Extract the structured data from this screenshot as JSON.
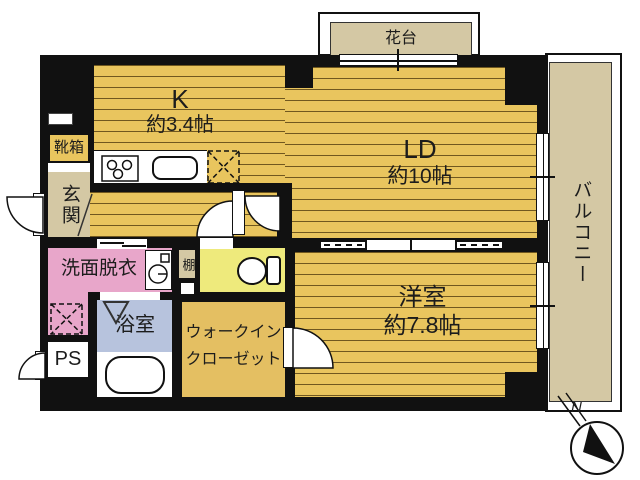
{
  "plan_title": "apartment floor plan",
  "colors": {
    "floor_wood": "#e9c55e",
    "tan": "#d4c8a4",
    "wall": "#111111",
    "washroom_pink": "#e8a6ca",
    "bath_blue": "#b7c3dd",
    "toilet_yellow": "#eeea7c",
    "closet_tan": "#e4bf62"
  },
  "rooms": {
    "kitchen": {
      "label": "K",
      "size": "約3.4帖"
    },
    "living_dining": {
      "label": "LD",
      "size": "約10帖"
    },
    "western_room": {
      "label": "洋室",
      "size": "約7.8帖"
    },
    "entrance": {
      "label": "玄関"
    },
    "shoe_box": {
      "label": "靴箱"
    },
    "washroom": {
      "label": "洗面脱衣"
    },
    "bathroom": {
      "label": "浴室"
    },
    "pipe_space": {
      "label": "PS"
    },
    "shelf": {
      "label": "棚"
    },
    "walk_in_closet": {
      "label_line1": "ウォークイン",
      "label_line2": "クローゼット"
    },
    "balcony": {
      "label": "バルコニー"
    },
    "flower_stand": {
      "label": "花台"
    }
  },
  "compass": {
    "north_label": "N"
  }
}
